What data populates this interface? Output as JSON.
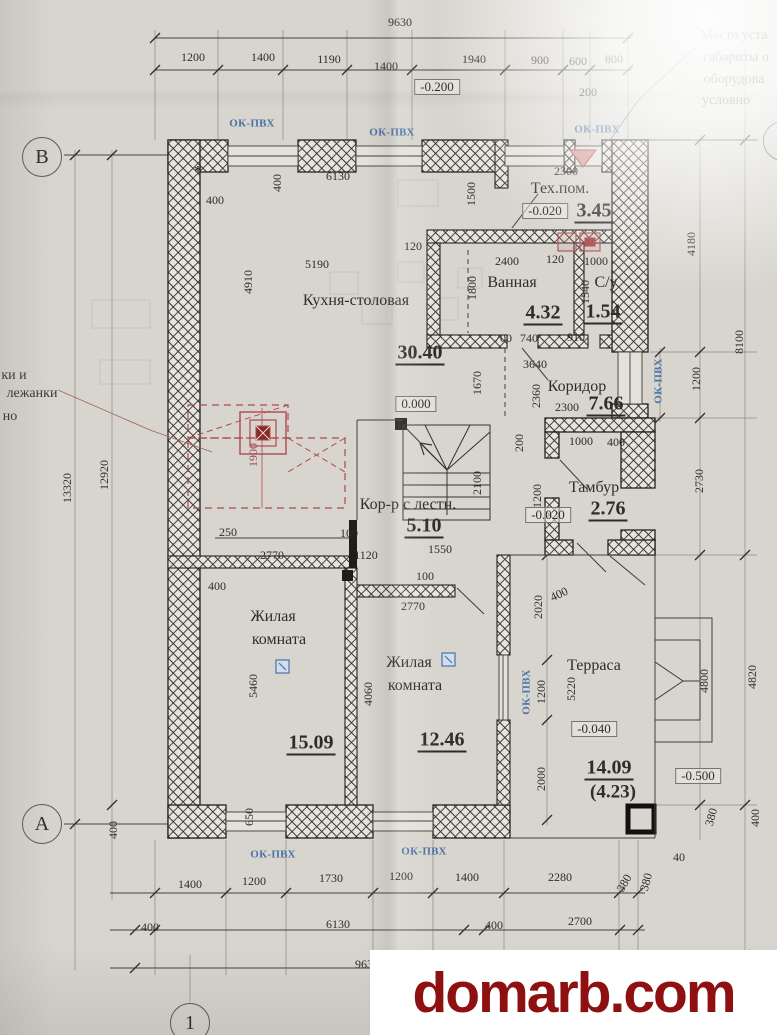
{
  "title": "Floor plan drawing (first floor), photographed sheet",
  "watermark": {
    "text": "domarb.com",
    "color": "#8e1011"
  },
  "axis_markers": [
    "В",
    "А",
    "1"
  ],
  "window_tag": "ОК-ПВХ",
  "rooms": [
    {
      "name": "Кухня-столовая",
      "area": "30.40",
      "elevation": "0.000"
    },
    {
      "name": "Тех.пом.",
      "area": "3.45",
      "elevation": "-0.020"
    },
    {
      "name": "Ванная",
      "area": "4.32"
    },
    {
      "name": "С/у",
      "area": "1.54"
    },
    {
      "name": "Коридор",
      "area": "7.66"
    },
    {
      "name": "Тамбур",
      "area": "2.76",
      "elevation": "-0.020"
    },
    {
      "name": "Кор-р с лестн.",
      "area": "5.10"
    },
    {
      "name": "Жилая комната",
      "area": "15.09"
    },
    {
      "name": "Жилая комната",
      "area": "12.46"
    },
    {
      "name": "Терраса",
      "area": "14.09",
      "area_secondary": "(4.23)",
      "elevation": "-0.040"
    }
  ],
  "outside_elevations": [
    "-0.200",
    "-0.500"
  ],
  "notes": {
    "top_right_lines": [
      "Место уста",
      "габариты о",
      "оборудова",
      "условно"
    ],
    "left_lines": [
      "ки и",
      "лежанки",
      "но"
    ]
  },
  "overall_dimensions": {
    "top": "9630",
    "bottom": "9630",
    "left": "13320",
    "right": "8100"
  },
  "labels": [
    {
      "t": "9630",
      "x": 400,
      "y": 22
    },
    {
      "t": "1200",
      "x": 193,
      "y": 57
    },
    {
      "t": "1400",
      "x": 263,
      "y": 57
    },
    {
      "t": "1190",
      "x": 329,
      "y": 59
    },
    {
      "t": "1400",
      "x": 386,
      "y": 66
    },
    {
      "t": "1940",
      "x": 474,
      "y": 59
    },
    {
      "t": "900",
      "x": 540,
      "y": 60
    },
    {
      "t": "600",
      "x": 578,
      "y": 61
    },
    {
      "t": "800",
      "x": 614,
      "y": 59
    },
    {
      "t": "200",
      "x": 588,
      "y": 92
    },
    {
      "t": "2300",
      "x": 566,
      "y": 171
    },
    {
      "t": "1500",
      "x": 471,
      "y": 194,
      "r": -90
    },
    {
      "t": "*",
      "x": 198,
      "y": 172,
      "c": "star"
    },
    {
      "t": "400",
      "x": 215,
      "y": 200
    },
    {
      "t": "400",
      "x": 277,
      "y": 183,
      "r": -90
    },
    {
      "t": "6130",
      "x": 338,
      "y": 176
    },
    {
      "t": "5190",
      "x": 317,
      "y": 264
    },
    {
      "t": "4910",
      "x": 248,
      "y": 282,
      "r": -90
    },
    {
      "t": "120",
      "x": 413,
      "y": 246
    },
    {
      "t": "2400",
      "x": 507,
      "y": 261
    },
    {
      "t": "120",
      "x": 555,
      "y": 259
    },
    {
      "t": "1000",
      "x": 596,
      "y": 261
    },
    {
      "t": "1800",
      "x": 472,
      "y": 288,
      "r": -90
    },
    {
      "t": "1540",
      "x": 585,
      "y": 292,
      "r": -90
    },
    {
      "t": "700",
      "x": 503,
      "y": 338
    },
    {
      "t": "740",
      "x": 529,
      "y": 338
    },
    {
      "t": "910",
      "x": 576,
      "y": 337
    },
    {
      "t": "3640",
      "x": 535,
      "y": 364
    },
    {
      "t": "2360",
      "x": 536,
      "y": 396,
      "r": -90
    },
    {
      "t": "1670",
      "x": 477,
      "y": 383,
      "r": -90
    },
    {
      "t": "2300",
      "x": 567,
      "y": 407
    },
    {
      "t": "200",
      "x": 519,
      "y": 443,
      "r": -90
    },
    {
      "t": "1000",
      "x": 581,
      "y": 441
    },
    {
      "t": "400",
      "x": 616,
      "y": 442
    },
    {
      "t": "1200",
      "x": 537,
      "y": 496,
      "r": -90
    },
    {
      "t": "2100",
      "x": 477,
      "y": 483,
      "r": -90
    },
    {
      "t": "1900",
      "x": 253,
      "y": 455,
      "r": -90,
      "c": "red"
    },
    {
      "t": "250",
      "x": 228,
      "y": 532
    },
    {
      "t": "2770",
      "x": 272,
      "y": 555
    },
    {
      "t": "400",
      "x": 217,
      "y": 586
    },
    {
      "t": "100",
      "x": 349,
      "y": 533
    },
    {
      "t": "1120",
      "x": 366,
      "y": 555
    },
    {
      "t": "1550",
      "x": 440,
      "y": 549
    },
    {
      "t": "100",
      "x": 425,
      "y": 576
    },
    {
      "t": "2770",
      "x": 413,
      "y": 606
    },
    {
      "t": "5460",
      "x": 253,
      "y": 686,
      "r": -90
    },
    {
      "t": "4060",
      "x": 368,
      "y": 694,
      "r": -90
    },
    {
      "t": "650",
      "x": 249,
      "y": 817,
      "r": -90
    },
    {
      "t": "400",
      "x": 113,
      "y": 830,
      "r": -90
    },
    {
      "t": "13320",
      "x": 67,
      "y": 488,
      "r": -90
    },
    {
      "t": "12920",
      "x": 104,
      "y": 475,
      "r": -90
    },
    {
      "t": "2020",
      "x": 538,
      "y": 607,
      "r": -90
    },
    {
      "t": "400",
      "x": 559,
      "y": 594,
      "r": -25
    },
    {
      "t": "1200",
      "x": 541,
      "y": 692,
      "r": -90
    },
    {
      "t": "5220",
      "x": 571,
      "y": 689,
      "r": -90
    },
    {
      "t": "2000",
      "x": 541,
      "y": 779,
      "r": -90
    },
    {
      "t": "4800",
      "x": 704,
      "y": 681,
      "r": -90
    },
    {
      "t": "4820",
      "x": 752,
      "y": 677,
      "r": -90
    },
    {
      "t": "4180",
      "x": 691,
      "y": 244,
      "r": -90
    },
    {
      "t": "8100",
      "x": 739,
      "y": 342,
      "r": -90
    },
    {
      "t": "1200",
      "x": 696,
      "y": 379,
      "r": -90
    },
    {
      "t": "2730",
      "x": 699,
      "y": 481,
      "r": -90
    },
    {
      "t": "380",
      "x": 711,
      "y": 817,
      "r": -75
    },
    {
      "t": "400",
      "x": 755,
      "y": 818,
      "r": -90
    },
    {
      "t": "40",
      "x": 679,
      "y": 857
    },
    {
      "t": "380",
      "x": 646,
      "y": 882,
      "r": -75
    },
    {
      "t": "1400",
      "x": 190,
      "y": 884
    },
    {
      "t": "1200",
      "x": 254,
      "y": 881
    },
    {
      "t": "1730",
      "x": 331,
      "y": 878
    },
    {
      "t": "1200",
      "x": 401,
      "y": 876
    },
    {
      "t": "1400",
      "x": 467,
      "y": 877
    },
    {
      "t": "2280",
      "x": 560,
      "y": 877
    },
    {
      "t": "380",
      "x": 624,
      "y": 883,
      "r": -60
    },
    {
      "t": "400",
      "x": 150,
      "y": 927
    },
    {
      "t": "6130",
      "x": 338,
      "y": 924
    },
    {
      "t": "400",
      "x": 494,
      "y": 925
    },
    {
      "t": "2700",
      "x": 580,
      "y": 921
    },
    {
      "t": "9630",
      "x": 367,
      "y": 964
    },
    {
      "t": "Кухня-столовая",
      "x": 356,
      "y": 301,
      "c": "room"
    },
    {
      "t": "Тех.пом.",
      "x": 560,
      "y": 189,
      "c": "room"
    },
    {
      "t": "Ванная",
      "x": 512,
      "y": 283,
      "c": "room"
    },
    {
      "t": "С/у",
      "x": 606,
      "y": 283,
      "c": "room"
    },
    {
      "t": "Коридор",
      "x": 577,
      "y": 387,
      "c": "room"
    },
    {
      "t": "Тамбур",
      "x": 594,
      "y": 488,
      "c": "room"
    },
    {
      "t": "Кор-р с лестн.",
      "x": 408,
      "y": 505,
      "c": "room"
    },
    {
      "t": "Жилая",
      "x": 273,
      "y": 617,
      "c": "room"
    },
    {
      "t": "комната",
      "x": 279,
      "y": 640,
      "c": "room"
    },
    {
      "t": "Жилая",
      "x": 409,
      "y": 663,
      "c": "room"
    },
    {
      "t": "комната",
      "x": 415,
      "y": 686,
      "c": "room"
    },
    {
      "t": "Терраса",
      "x": 594,
      "y": 666,
      "c": "room"
    },
    {
      "t": "30.40",
      "x": 420,
      "y": 354,
      "c": "area"
    },
    {
      "t": "3.45",
      "x": 594,
      "y": 212,
      "c": "area"
    },
    {
      "t": "4.32",
      "x": 543,
      "y": 314,
      "c": "area"
    },
    {
      "t": "1.54",
      "x": 603,
      "y": 313,
      "c": "area"
    },
    {
      "t": "7.66",
      "x": 606,
      "y": 405,
      "c": "area"
    },
    {
      "t": "2.76",
      "x": 608,
      "y": 510,
      "c": "area"
    },
    {
      "t": "5.10",
      "x": 424,
      "y": 527,
      "c": "area"
    },
    {
      "t": "15.09",
      "x": 311,
      "y": 744,
      "c": "area"
    },
    {
      "t": "12.46",
      "x": 442,
      "y": 741,
      "c": "area"
    },
    {
      "t": "14.09",
      "x": 609,
      "y": 769,
      "c": "area"
    },
    {
      "t": "(4.23)",
      "x": 613,
      "y": 792,
      "c": "areap"
    },
    {
      "t": "-0.200",
      "x": 437,
      "y": 87,
      "c": "elev"
    },
    {
      "t": "0.000",
      "x": 416,
      "y": 404,
      "c": "elev"
    },
    {
      "t": "-0.020",
      "x": 545,
      "y": 211,
      "c": "elev"
    },
    {
      "t": "-0.020",
      "x": 548,
      "y": 515,
      "c": "elev"
    },
    {
      "t": "-0.040",
      "x": 594,
      "y": 729,
      "c": "elev"
    },
    {
      "t": "-0.500",
      "x": 698,
      "y": 776,
      "c": "elev"
    },
    {
      "t": "ОК-ПВХ",
      "x": 252,
      "y": 124,
      "c": "win"
    },
    {
      "t": "ОК-ПВХ",
      "x": 392,
      "y": 133,
      "c": "win"
    },
    {
      "t": "ОК-ПВХ",
      "x": 597,
      "y": 130,
      "c": "win"
    },
    {
      "t": "ОК-ПВХ",
      "x": 659,
      "y": 381,
      "r": -90,
      "c": "win"
    },
    {
      "t": "ОК-ПВХ",
      "x": 527,
      "y": 692,
      "r": -90,
      "c": "win"
    },
    {
      "t": "ОК-ПВХ",
      "x": 273,
      "y": 855,
      "c": "win"
    },
    {
      "t": "ОК-ПВХ",
      "x": 424,
      "y": 852,
      "c": "win"
    },
    {
      "t": "Место уста",
      "x": 734,
      "y": 36,
      "c": "note"
    },
    {
      "t": "габариты о",
      "x": 736,
      "y": 58,
      "c": "note"
    },
    {
      "t": "оборудова",
      "x": 734,
      "y": 80,
      "c": "note"
    },
    {
      "t": "условно",
      "x": 726,
      "y": 101,
      "c": "note"
    },
    {
      "t": "ки и",
      "x": 14,
      "y": 376,
      "c": "note"
    },
    {
      "t": "лежанки",
      "x": 32,
      "y": 394,
      "c": "note"
    },
    {
      "t": "но",
      "x": 10,
      "y": 417,
      "c": "note"
    },
    {
      "t": "В",
      "x": 42,
      "y": 157,
      "c": "axis"
    },
    {
      "t": "А",
      "x": 42,
      "y": 824,
      "c": "axis"
    },
    {
      "t": "1",
      "x": 190,
      "y": 1023,
      "c": "axis"
    },
    {
      "t": "",
      "x": 783,
      "y": 141,
      "c": "axis"
    }
  ]
}
